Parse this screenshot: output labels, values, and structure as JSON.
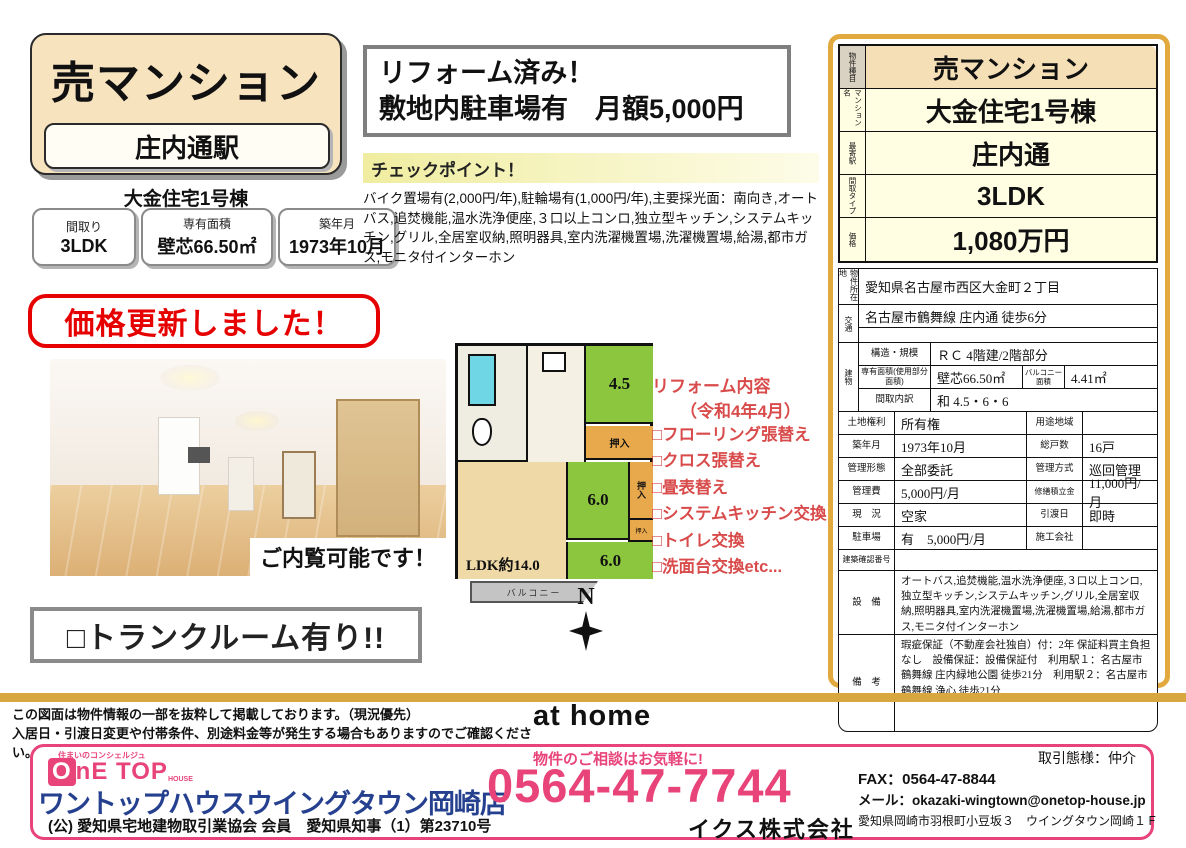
{
  "left": {
    "title": "売マンション",
    "station": "庄内通駅",
    "building_name": "大金住宅1号棟",
    "badges": [
      {
        "label": "間取り",
        "value": "3LDK"
      },
      {
        "label": "専有面積",
        "value": "壁芯66.50㎡"
      },
      {
        "label": "築年月",
        "value": "1973年10月"
      }
    ],
    "price_update": "価格更新しました！",
    "photo_caption": "ご内覧可能です！",
    "trunk_room": "□トランクルーム有り!!"
  },
  "highlight": {
    "line1": "リフォーム済み！",
    "line2": "敷地内駐車場有　月額5,000円"
  },
  "checkpoint": {
    "title": "チェックポイント！",
    "body": "バイク置場有(2,000円/年),駐輪場有(1,000円/年),主要採光面：南向き,オートバス,追焚機能,温水洗浄便座,３口以上コンロ,独立型キッチン,システムキッチン,グリル,全居室収納,照明器具,室内洗濯機置場,洗濯機置場,給湯,都市ガス,モニタ付インターホン"
  },
  "floorplan": {
    "ldk": "LDK約14.0",
    "room_45": "4.5",
    "room_6a": "6.0",
    "room_6b": "6.0",
    "closet1": "押入",
    "closet2": "押入",
    "closet3": "押入",
    "balcony": "バルコニー",
    "compass": "N"
  },
  "reform": {
    "title": "リフォーム内容",
    "subtitle": "（令和4年4月）",
    "items": [
      "□フローリング張替え",
      "□クロス張替え",
      "□畳表替え",
      "□システムキッチン交換",
      "□トイレ交換",
      "□洗面台交換etc..."
    ]
  },
  "summary": {
    "rows": [
      {
        "label": "物件種目",
        "value": "売マンション"
      },
      {
        "label": "マンション名",
        "value": "大金住宅1号棟"
      },
      {
        "label": "最寄駅",
        "value": "庄内通"
      },
      {
        "label": "間取タイプ",
        "value": "3LDK"
      },
      {
        "label": "価格",
        "value": "1,080万円"
      }
    ]
  },
  "details": {
    "location": {
      "label": "物件所在地",
      "value": "愛知県名古屋市西区大金町２丁目"
    },
    "transport": {
      "label": "交通",
      "value": "名古屋市鶴舞線 庄内通 徒歩6分",
      "value2": ""
    },
    "building": {
      "label": "建物",
      "structure_label": "構造・規模",
      "structure": "ＲＣ 4階建/2階部分",
      "area_label": "専有面積(使用部分面積)",
      "area": "壁芯66.50㎡",
      "balcony_label": "バルコニー面積",
      "balcony": "4.41㎡",
      "layout_label": "間取内訳",
      "layout": "和 4.5・6・6"
    },
    "rows": [
      {
        "l1": "土地権利",
        "v1": "所有権",
        "l2": "用途地域",
        "v2": ""
      },
      {
        "l1": "築年月",
        "v1": "1973年10月",
        "l2": "総戸数",
        "v2": "16戸"
      },
      {
        "l1": "管理形態",
        "v1": "全部委託",
        "l2": "管理方式",
        "v2": "巡回管理"
      },
      {
        "l1": "管理費",
        "v1": "5,000円/月",
        "l2": "修繕積立金",
        "v2": "11,000円/月"
      },
      {
        "l1": "現　況",
        "v1": "空家",
        "l2": "引渡日",
        "v2": "即時"
      },
      {
        "l1": "駐車場",
        "v1": "有　5,000円/月",
        "l2": "施工会社",
        "v2": ""
      }
    ],
    "confirmation_label": "建築確認番号",
    "confirmation_value": "",
    "equipment_label": "設　備",
    "equipment": "オートバス,追焚機能,温水洗浄便座,３口以上コンロ,独立型キッチン,システムキッチン,グリル,全居室収納,照明器具,室内洗濯機置場,洗濯機置場,給湯,都市ガス,モニタ付インターホン",
    "remarks_label": "備　考",
    "remarks": "瑕疵保証（不動産会社独自）付：2年 保証料買主負担なし　設備保証：設備保証付　利用駅１：名古屋市鶴舞線 庄内緑地公園 徒歩21分　利用駅２：名古屋市鶴舞線 浄心 徒歩21分"
  },
  "footer": {
    "disclaimer1": "この図面は物件情報の一部を抜粋して掲載しております。（現況優先）",
    "disclaimer2": "入居日・引渡日変更や付帯条件、別途料金等が発生する場合もありますのでご確認ください。",
    "athome_logo": "at home",
    "onetop_tagline": "住まいのコンシェルジュ",
    "onetop_o": "O",
    "onetop_rest": "nE TOP",
    "onetop_house": "HOUSE",
    "company": "ワントップハウスウイングタウン岡崎店",
    "license": "(公) 愛知県宅地建物取引業協会 会員　愛知県知事（1）第23710号",
    "phone_label": "物件のご相談はお気軽に!",
    "phone": "0564-47-7744",
    "corp": "イクス株式会社",
    "deal_type": "取引態様：仲介",
    "fax": "FAX：0564-47-8844",
    "email": "メール：okazaki-wingtown@onetop-house.jp",
    "address": "愛知県岡崎市羽根町小豆坂３　ウイングタウン岡崎１Ｆ"
  },
  "colors": {
    "accent_gold": "#e2a93f",
    "accent_red": "#e60000",
    "accent_pink": "#e8447a",
    "brand_blue": "#25408f",
    "tatami_green": "#8cc63f",
    "closet_orange": "#e8a84c",
    "ldk_tan": "#efd9a6"
  }
}
